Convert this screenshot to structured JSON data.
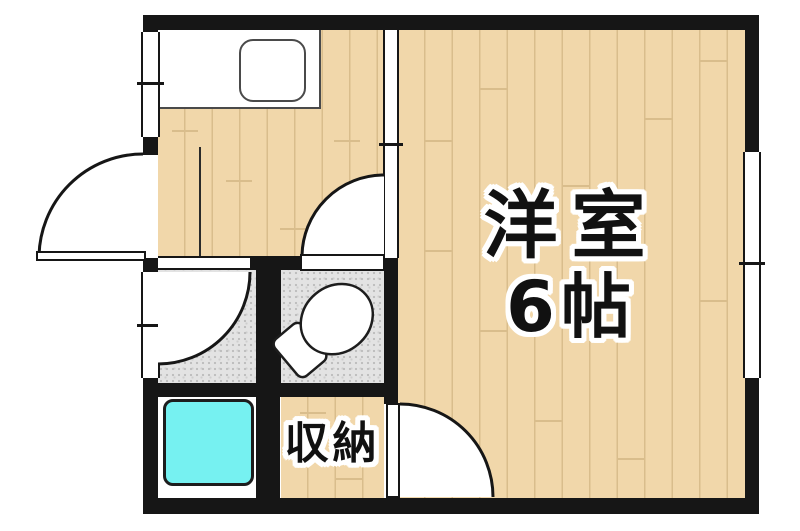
{
  "floorplan": {
    "kind": "japanese-apartment-floor-plan",
    "labels": {
      "main_room_line1": "洋室",
      "main_room_line2": "6帖",
      "closet": "収納"
    },
    "icons": {
      "toilet": "toilet-icon",
      "bathtub": "bathtub-icon",
      "kitchen_sink": "sink-icon",
      "entry_tiles": "genkan-tile-icon",
      "door_swing": "door-swing-arc-icon",
      "window": "window-symbol-icon",
      "sliding_door": "sliding-door-symbol-icon"
    },
    "colors": {
      "wall": "#161616",
      "wood_floor": "#f1d7aa",
      "plank_line": "#d9bd8c",
      "tile_floor": "#e3e3e3",
      "genkan_tile": "#dcdcdc",
      "bathtub": "#76f1f1",
      "fixture_outline": "#1d1d1d",
      "background": "#ffffff"
    }
  }
}
